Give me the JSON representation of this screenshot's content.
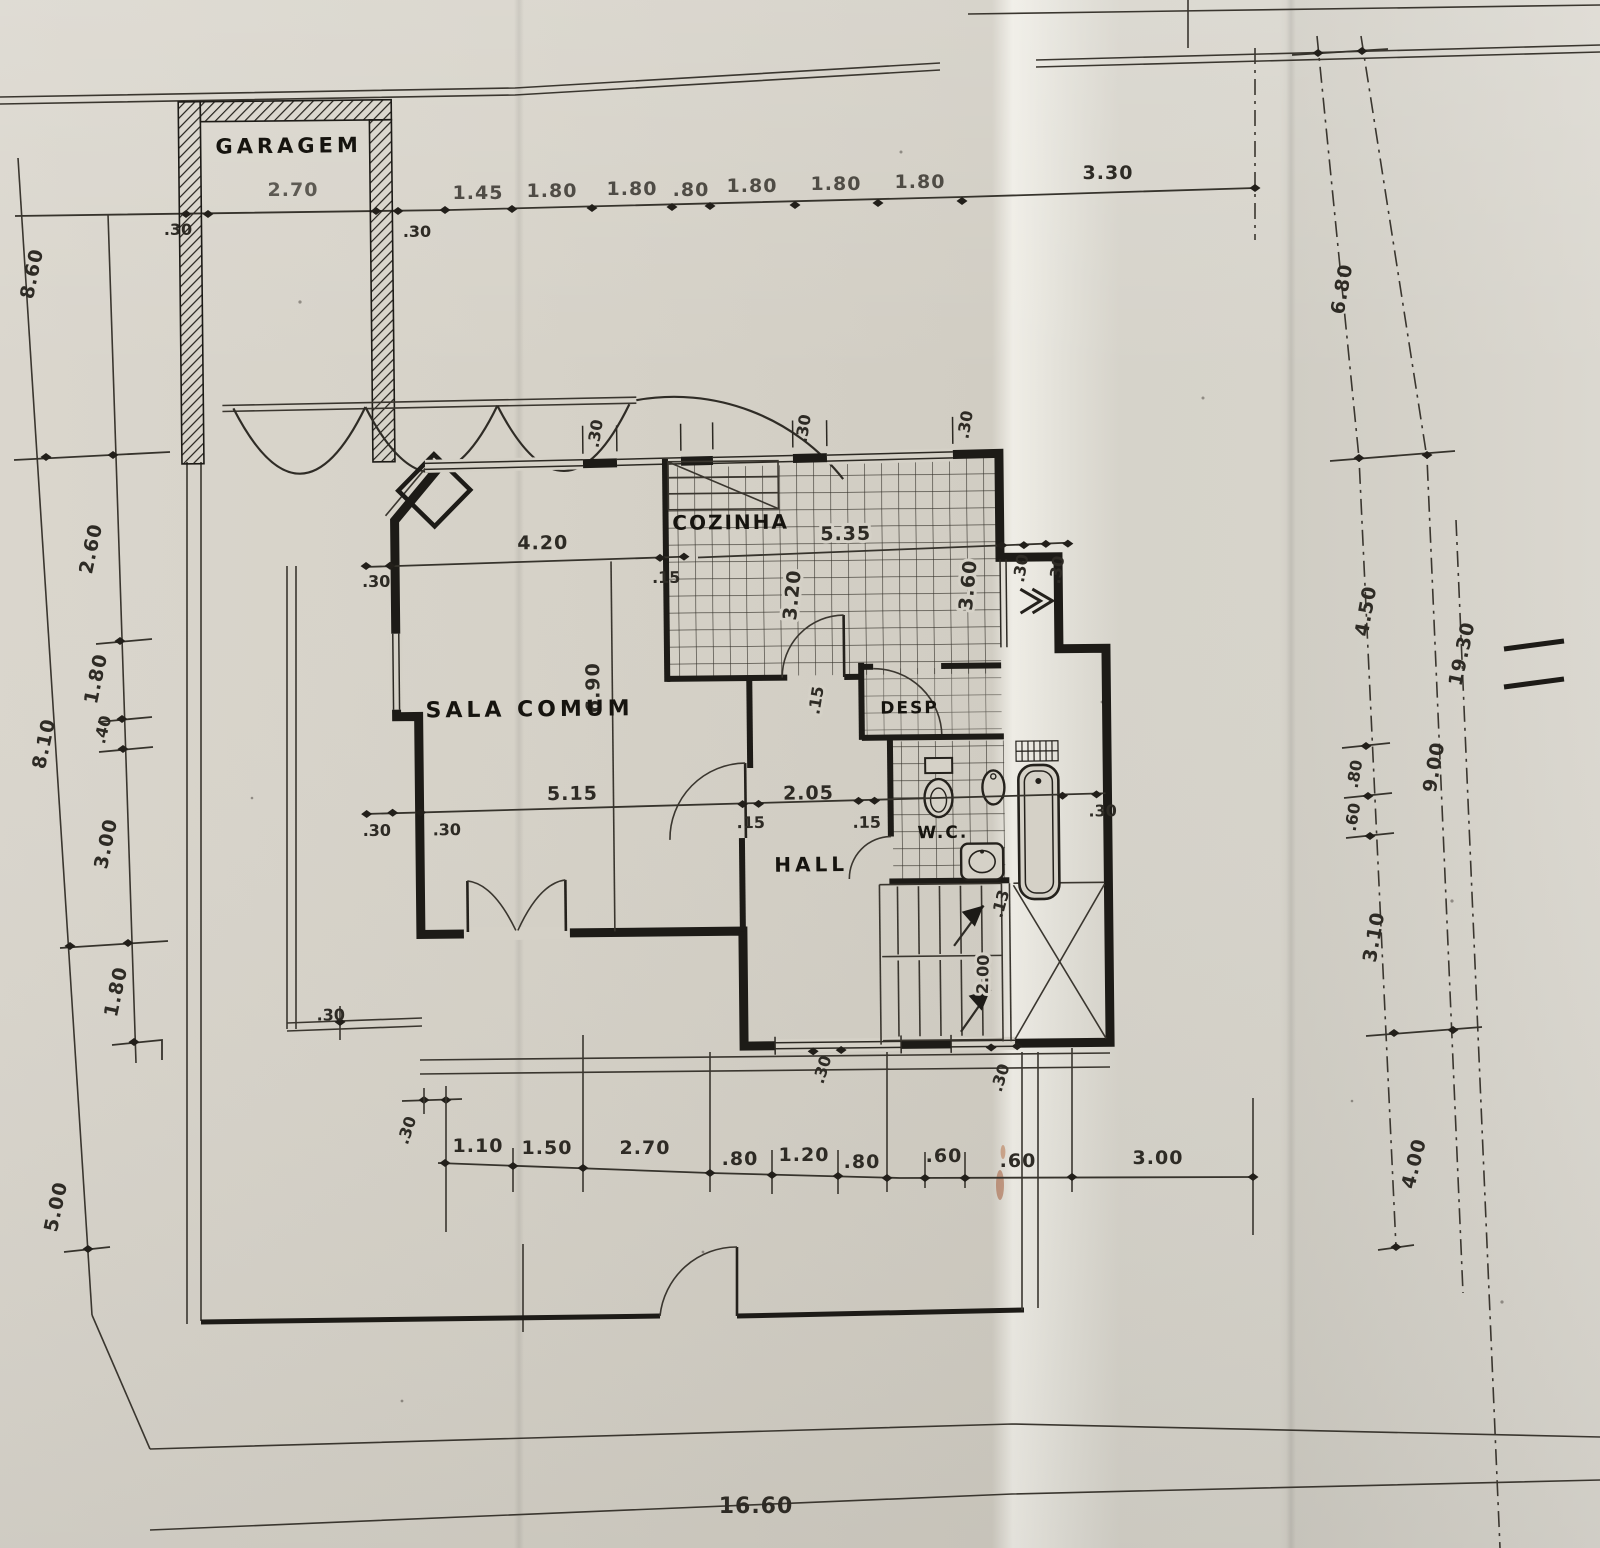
{
  "sheet": {
    "bottom_total": "16.60",
    "right_total": "19.30"
  },
  "rooms": {
    "garagem": "GARAGEM",
    "sala_comum": "SALA COMUM",
    "cozinha": "COZINHA",
    "desp": "DESP",
    "wc": "W.C.",
    "hall": "HALL"
  },
  "chains": {
    "top": [
      ".30",
      "2.70",
      ".30",
      "1.45",
      "1.80",
      "1.80",
      ".80",
      "1.80",
      "1.80",
      "1.80",
      "3.30"
    ],
    "left_outer": [
      "8.60",
      "8.10",
      "5.00"
    ],
    "left_inner": [
      "2.60",
      "1.80",
      ".40",
      "3.00",
      "1.80"
    ],
    "right_inner": [
      "6.80",
      "4.50",
      ".80",
      ".60",
      "3.10"
    ],
    "right_outer": [
      "9.00",
      "4.00"
    ],
    "bottom": [
      ".30",
      "1.10",
      "1.50",
      "2.70",
      ".80",
      "1.20",
      ".80",
      ".60",
      ".60",
      "3.00"
    ]
  },
  "interior": {
    "sala_width": "4.20",
    "sala_height": "6.90",
    "sala_wall_left": ".30",
    "sala_wall_right": ".15",
    "mid_chain": [
      ".30",
      ".30",
      "5.15",
      ".15",
      "2.05",
      ".15",
      ".30"
    ],
    "kitchen_width": "5.35",
    "kitchen_depth_left": "3.20",
    "kitchen_depth_right": "3.60",
    "kitchen_wall_right_a": ".30",
    "kitchen_wall_right_b": ".30",
    "kitchen_wall_south": ".15",
    "north_pier_a": ".30",
    "north_pier_b": ".30",
    "north_pier_c": ".30",
    "stair_tread": ".13",
    "stair_width": "2.00",
    "south_wall_a": ".30",
    "south_wall_b": ".30",
    "terrace_wall": ".30"
  }
}
